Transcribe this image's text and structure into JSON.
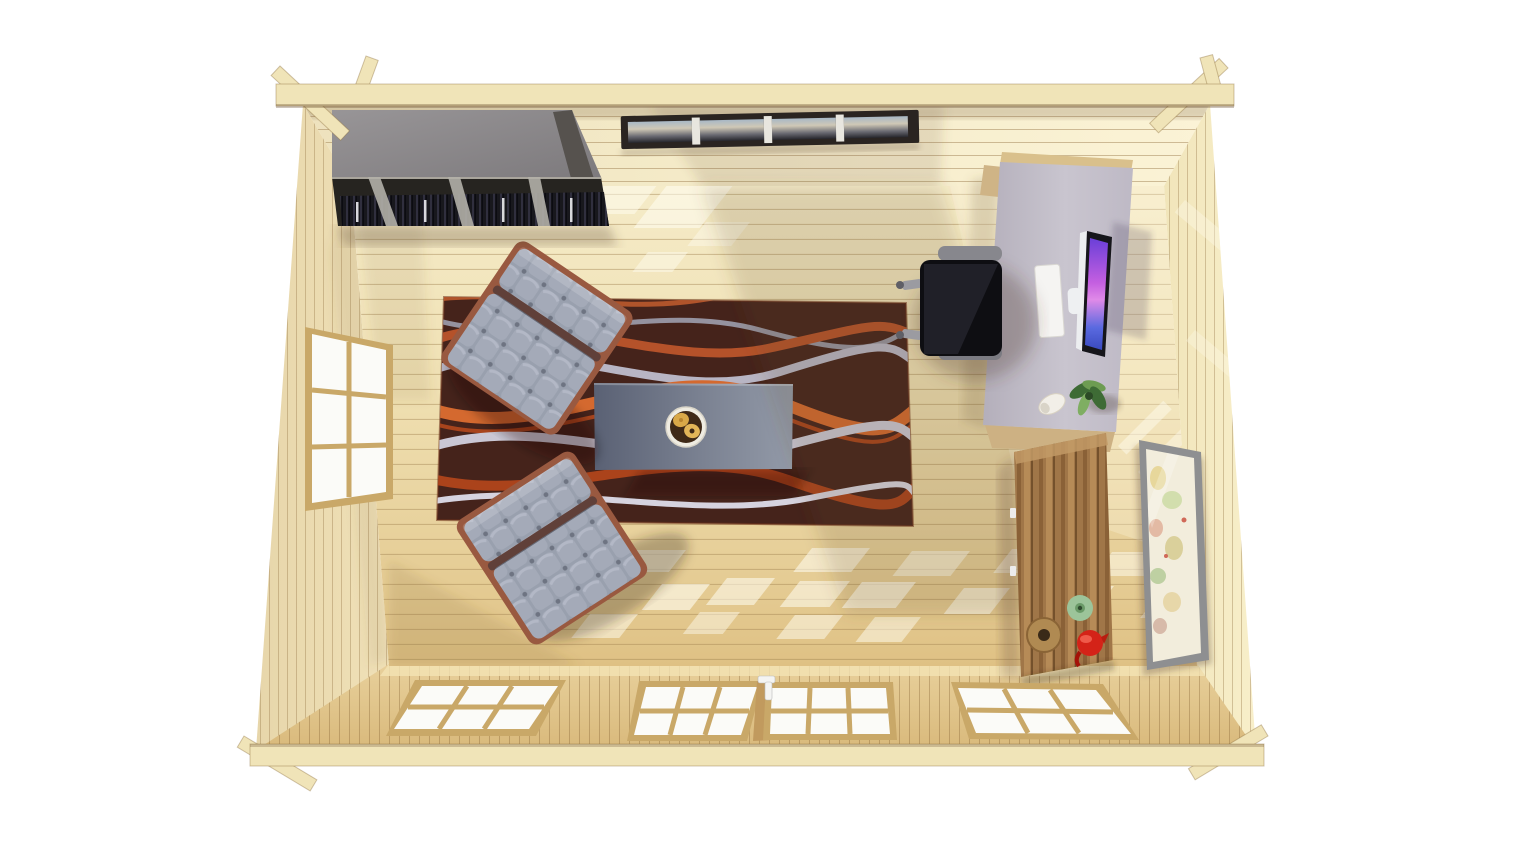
{
  "scene": {
    "title": "Top-down 3D render of a log-cabin home office with lounge chairs, rug, desk and cabinet",
    "background": "#ffffff"
  },
  "palette": {
    "roof_beam": "#f0e4b8",
    "wood_wall_left": "#ebdcb2",
    "wood_wall_back": "#f3e9c6",
    "wood_wall_right": "#f6ecc4",
    "wood_wall_front": "#ddbf85",
    "wood_floor": "#efdfb3",
    "window_frame": "#c9a868",
    "window_glass": "#fbfbf8"
  },
  "objects": {
    "bookshelf": {
      "label": "wall-mounted bookshelf with books",
      "top_color": "#8d8a8c",
      "shelf_color": "#262420"
    },
    "gallery": {
      "label": "row of four framed panorama pictures",
      "frame_color": "#2a2421",
      "count": 4
    },
    "rug": {
      "label": "dark rug with wavy stripes",
      "base_color": "#45231b",
      "wave_orange": "#d4692f",
      "wave_silver": "#b8b5c4"
    },
    "coffee_table": {
      "label": "rectangular coffee table",
      "color": "#6b7284"
    },
    "snack_bowl": {
      "label": "bowl with cookies",
      "rim_color": "#efece2",
      "inside_color": "#3f2917",
      "cookie_color": "#d9a848"
    },
    "armchair_upper": {
      "label": "tufted lounge chair (upper)",
      "cushion_color": "#9aa0ae",
      "frame_color": "#995940"
    },
    "armchair_lower": {
      "label": "tufted lounge chair (lower)",
      "cushion_color": "#9aa0ae",
      "frame_color": "#995940"
    },
    "desk": {
      "label": "writing desk",
      "color": "#bfbac6"
    },
    "monitor": {
      "label": "computer monitor",
      "bezel_color": "#16161b",
      "screen_color": "#c45fe0"
    },
    "keyboard": {
      "label": "white keyboard",
      "color": "#f5f4f2"
    },
    "office_chair": {
      "label": "black office chair",
      "seat_color": "#0e0e12",
      "armrest_color": "#87878d"
    },
    "desk_plant": {
      "label": "potted plant on desk",
      "leaf_dark": "#3e6b35",
      "leaf_light": "#7fae62"
    },
    "mug": {
      "label": "white cup on desk",
      "color": "#f2efe8"
    },
    "cabinet": {
      "label": "tall wooden cabinet",
      "color": "#a07648"
    },
    "wood_ring": {
      "label": "wooden bowl on cabinet",
      "color": "#b08a52"
    },
    "green_vase": {
      "label": "green vase on cabinet",
      "color": "#9cc49a"
    },
    "red_kettle": {
      "label": "red kettle on cabinet",
      "color": "#d42318"
    },
    "map_frame": {
      "label": "framed world map",
      "frame_color": "#8e8f91",
      "paper_color": "#f2eddc"
    },
    "door_handle": {
      "label": "white door handle",
      "color": "#f4f4f2"
    }
  },
  "windows": {
    "left_wall_window": {
      "panes": 6
    },
    "front_window_left": {
      "panes": 6
    },
    "front_door_left": {
      "panes": 6
    },
    "front_door_right": {
      "panes": 6
    },
    "front_window_right": {
      "panes": 6
    }
  }
}
